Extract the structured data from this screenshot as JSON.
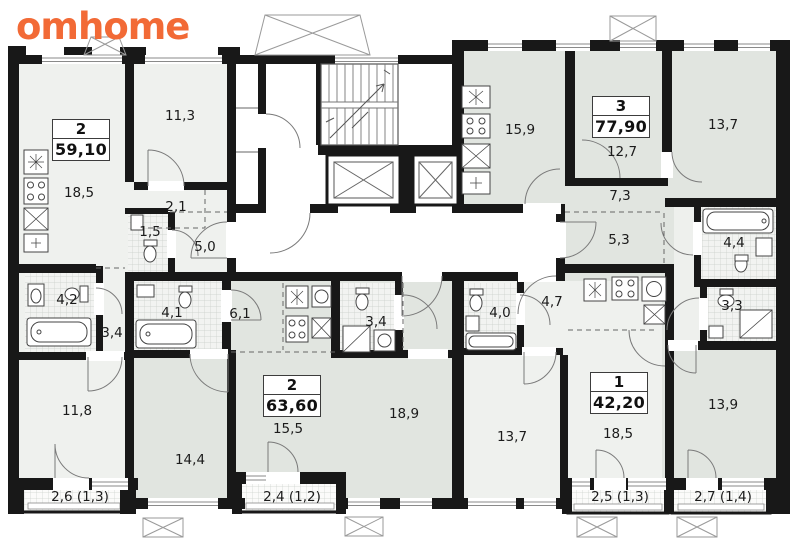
{
  "brand": {
    "logo_text": "omhome",
    "logo_color": "#f26a36"
  },
  "colors": {
    "wall": "#181818",
    "room_light": "#eff1ee",
    "room_gray": "#e1e5e0",
    "corridor": "#ffffff",
    "tile_line": "#c9cec9"
  },
  "floor_plan": {
    "apartments": [
      {
        "type": "2",
        "area": "59,10",
        "room_labels": [
          "18,5",
          "11,3",
          "2,1",
          "1,5",
          "5,0",
          "4,2",
          "3,4",
          "11,8"
        ],
        "balcony_label": "2,6 (1,3)"
      },
      {
        "type": "2",
        "area": "63,60",
        "room_labels": [
          "6,1",
          "4,1",
          "3,4",
          "15,5",
          "14,4",
          "18,9"
        ],
        "balcony_label": "2,4 (1,2)"
      },
      {
        "type": "1",
        "area": "42,20",
        "room_labels": [
          "4,7",
          "4,0",
          "13,7",
          "18,5"
        ],
        "balcony_label": "2,5 (1,3)"
      },
      {
        "type": "3",
        "area": "77,90",
        "room_labels": [
          "15,9",
          "12,7",
          "13,7",
          "7,3",
          "5,3",
          "4,4",
          "3,3",
          "13,9"
        ],
        "balcony_label": "2,7 (1,4)"
      }
    ]
  }
}
